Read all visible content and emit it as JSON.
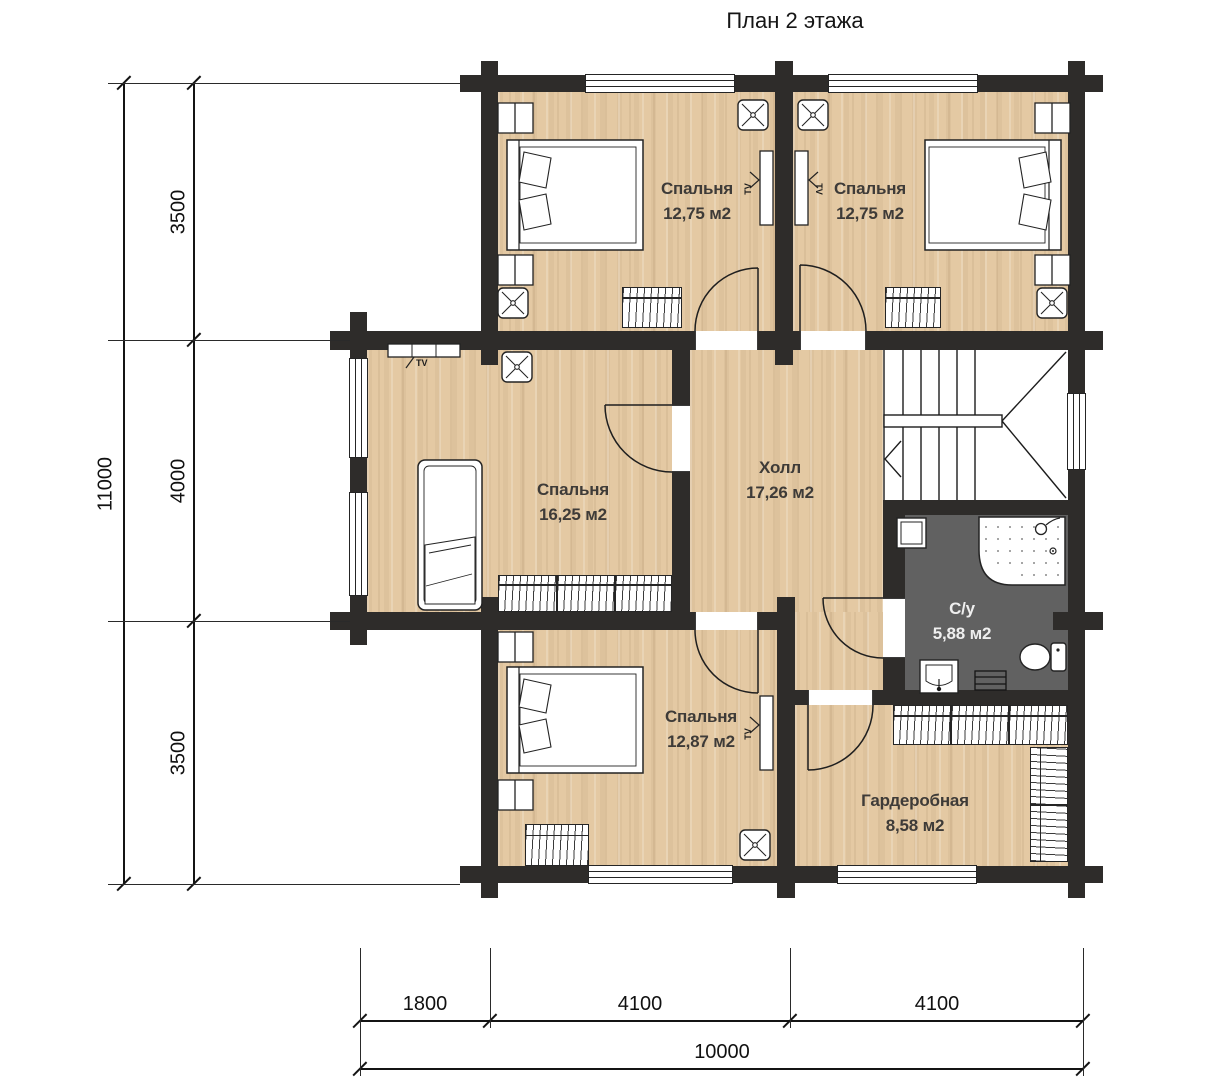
{
  "title": "План 2 этажа",
  "rooms": [
    {
      "name": "Спальня",
      "area": "12,75 м2"
    },
    {
      "name": "Спальня",
      "area": "12,75 м2"
    },
    {
      "name": "Спальня",
      "area": "16,25 м2"
    },
    {
      "name": "Холл",
      "area": "17,26 м2"
    },
    {
      "name": "С/у",
      "area": "5,88 м2"
    },
    {
      "name": "Спальня",
      "area": "12,87 м2"
    },
    {
      "name": "Гардеробная",
      "area": "8,58 м2"
    }
  ],
  "labels": {
    "tv": "TV"
  },
  "dimensions": {
    "left": {
      "total": "11000",
      "segments": [
        "3500",
        "4000",
        "3500"
      ]
    },
    "bottom": {
      "total": "10000",
      "segments": [
        "1800",
        "4100",
        "4100"
      ]
    }
  },
  "colors": {
    "wall": "#2e2c2a",
    "floor": "#e4c9a3",
    "bathroom_floor": "#616161",
    "line": "#1a1a1a"
  }
}
